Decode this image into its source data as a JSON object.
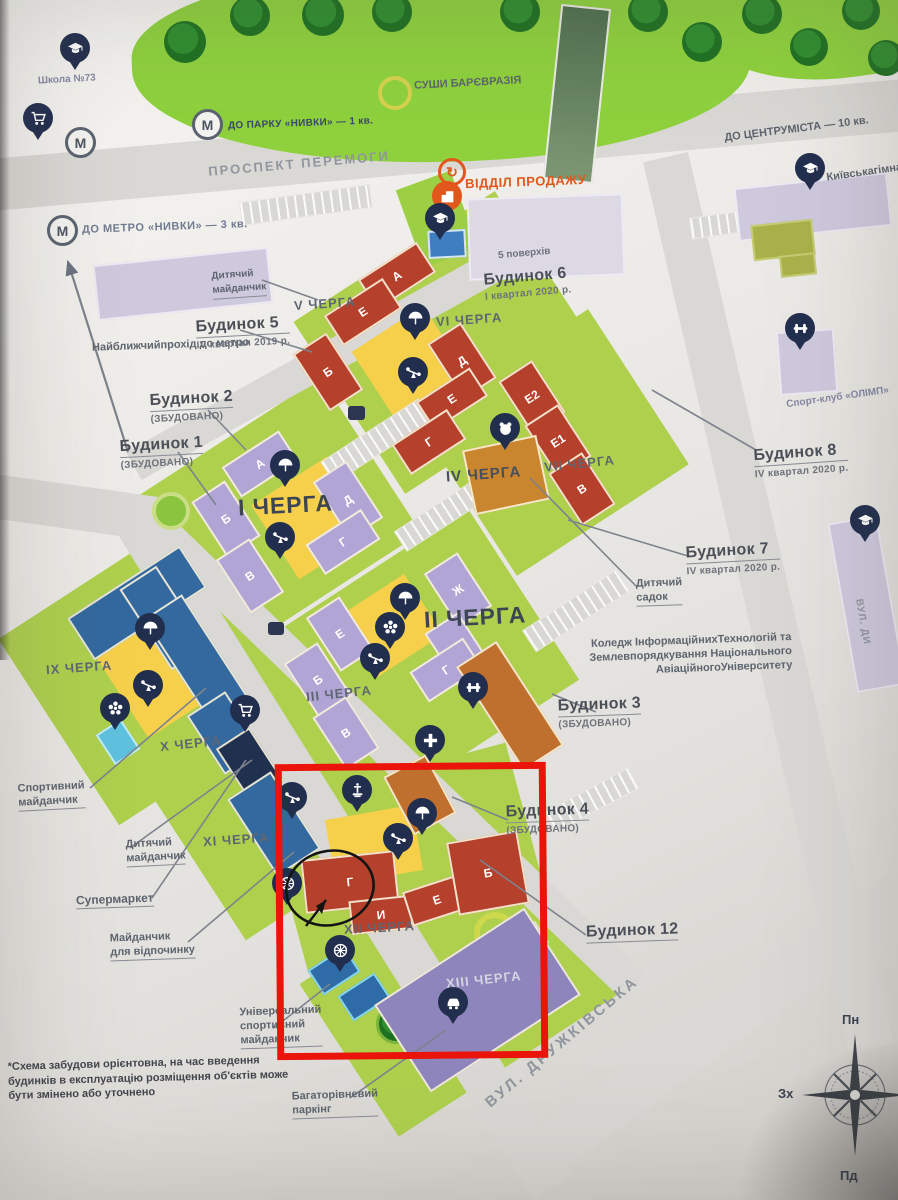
{
  "nav": {
    "school": "Школа №73",
    "metro_letter": "М",
    "to_metro": "ДО МЕТРО «НИВКИ» — 3 кв.",
    "nearest_pass_l1": "Найближчий",
    "nearest_pass_l2": "прохід до метро",
    "to_park": "ДО ПАРКУ «НИВКИ» — 1 кв.",
    "to_center_l1": "ДО ЦЕНТРУ",
    "to_center_l2": "МІСТА — 10 кв.",
    "sushi_l1": "СУШИ БАР",
    "sushi_l2": "ЄВРАЗІЯ",
    "sales_office": "ВІДДІЛ ПРОДАЖУ"
  },
  "streets": {
    "peremohy": "ПРОСПЕКТ ПЕРЕМОГИ",
    "druzhkivska": "ВУЛ. ДРУЖКІВСЬКА",
    "east": "ВУЛ. ДИ"
  },
  "landmarks": {
    "gymnasium_l1": "Київська",
    "gymnasium_l2": "гімназія №154",
    "sport_club": "Спорт-клуб «ОЛІМП»",
    "college_l1": "Коледж Інформаційних",
    "college_l2": "Технологій та Землевпорядкування",
    "college_l3": "Національного Авіаційного",
    "college_l4": "Університету",
    "kindergarten_l1": "Дитячий",
    "kindergarten_l2": "садок",
    "five_floors": "5 поверхів"
  },
  "houses": {
    "h1": {
      "name": "Будинок 1",
      "status": "(ЗБУДОВАНО)"
    },
    "h2": {
      "name": "Будинок 2",
      "status": "(ЗБУДОВАНО)"
    },
    "h3": {
      "name": "Будинок 3",
      "status": "(ЗБУДОВАНО)"
    },
    "h4": {
      "name": "Будинок 4",
      "status": "(ЗБУДОВАНО)"
    },
    "h5": {
      "name": "Будинок 5",
      "status": "IV квартал 2019 р."
    },
    "h6": {
      "name": "Будинок 6",
      "status": "І квартал 2020 р."
    },
    "h7": {
      "name": "Будинок 7",
      "status": "IV квартал 2020 р."
    },
    "h8": {
      "name": "Будинок 8",
      "status": "IV квартал 2020 р."
    },
    "h12": {
      "name": "Будинок 12"
    }
  },
  "phases": {
    "p1": "І ЧЕРГА",
    "p2": "ІІ ЧЕРГА",
    "p3": "ІІІ ЧЕРГА",
    "p4": "IV ЧЕРГА",
    "p5": "V ЧЕРГА",
    "p6": "VI ЧЕРГА",
    "p7": "VII ЧЕРГА",
    "p9": "IX ЧЕРГА",
    "p10": "X ЧЕРГА",
    "p11": "XI ЧЕРГА",
    "p12": "XII ЧЕРГА",
    "p13": "XIII ЧЕРГА"
  },
  "letters": {
    "p1": [
      "А",
      "Б",
      "В",
      "Д",
      "Г"
    ],
    "p2": [
      "Ж",
      "Д",
      "Г"
    ],
    "p3": [
      "Е",
      "Б",
      "В"
    ],
    "p5": [
      "А",
      "Е",
      "Б"
    ],
    "p6": [
      "Д",
      "Е",
      "Г"
    ],
    "p7": [
      "Е2",
      "Е1",
      "В"
    ],
    "p12": [
      "Г",
      "И",
      "Е",
      "Б"
    ]
  },
  "amenities": {
    "kids_top_l1": "Дитячий",
    "kids_top_l2": "майданчик",
    "sport_l1": "Спортивний",
    "sport_l2": "майданчик",
    "kids_left_l1": "Дитячий",
    "kids_left_l2": "майданчик",
    "supermarket": "Супермаркет",
    "rest_l1": "Майданчик",
    "rest_l2": "для відпочинку",
    "universal_l1": "Універсальний",
    "universal_l2": "спортивний",
    "universal_l3": "майданчик",
    "parking_l1": "Багаторівневий",
    "parking_l2": "паркінг"
  },
  "compass": {
    "n": "Пн",
    "w": "Зх",
    "s": "Пд"
  },
  "footnote": {
    "l1": "*Схема забудови орієнтовна, на час введення",
    "l2": "будинків в експлуатацію розміщення об'єктів",
    "l3": "може бути змінено або уточнено"
  },
  "colors": {
    "highlight_box": "#ea140a",
    "phase_red": "#b5402c",
    "phase_purple": "#b1a5d6",
    "phase_blue": "#33699f",
    "orange_building": "#c0702e",
    "ground_green": "#aed04d",
    "park_green": "#8ed13d",
    "pin_navy": "#222e4e",
    "accent_orange": "#e2571b"
  },
  "icons": [
    "umbrella-icon",
    "seesaw-icon",
    "ferris-wheel-icon",
    "flower-icon",
    "dumbbell-icon",
    "medical-cross-icon",
    "cart-icon",
    "fountain-icon",
    "car-icon",
    "graduation-cap-icon",
    "metro-m-icon",
    "sales-building-icon",
    "bear-icon",
    "refresh-arrow-icon",
    "compass-rose-icon"
  ]
}
